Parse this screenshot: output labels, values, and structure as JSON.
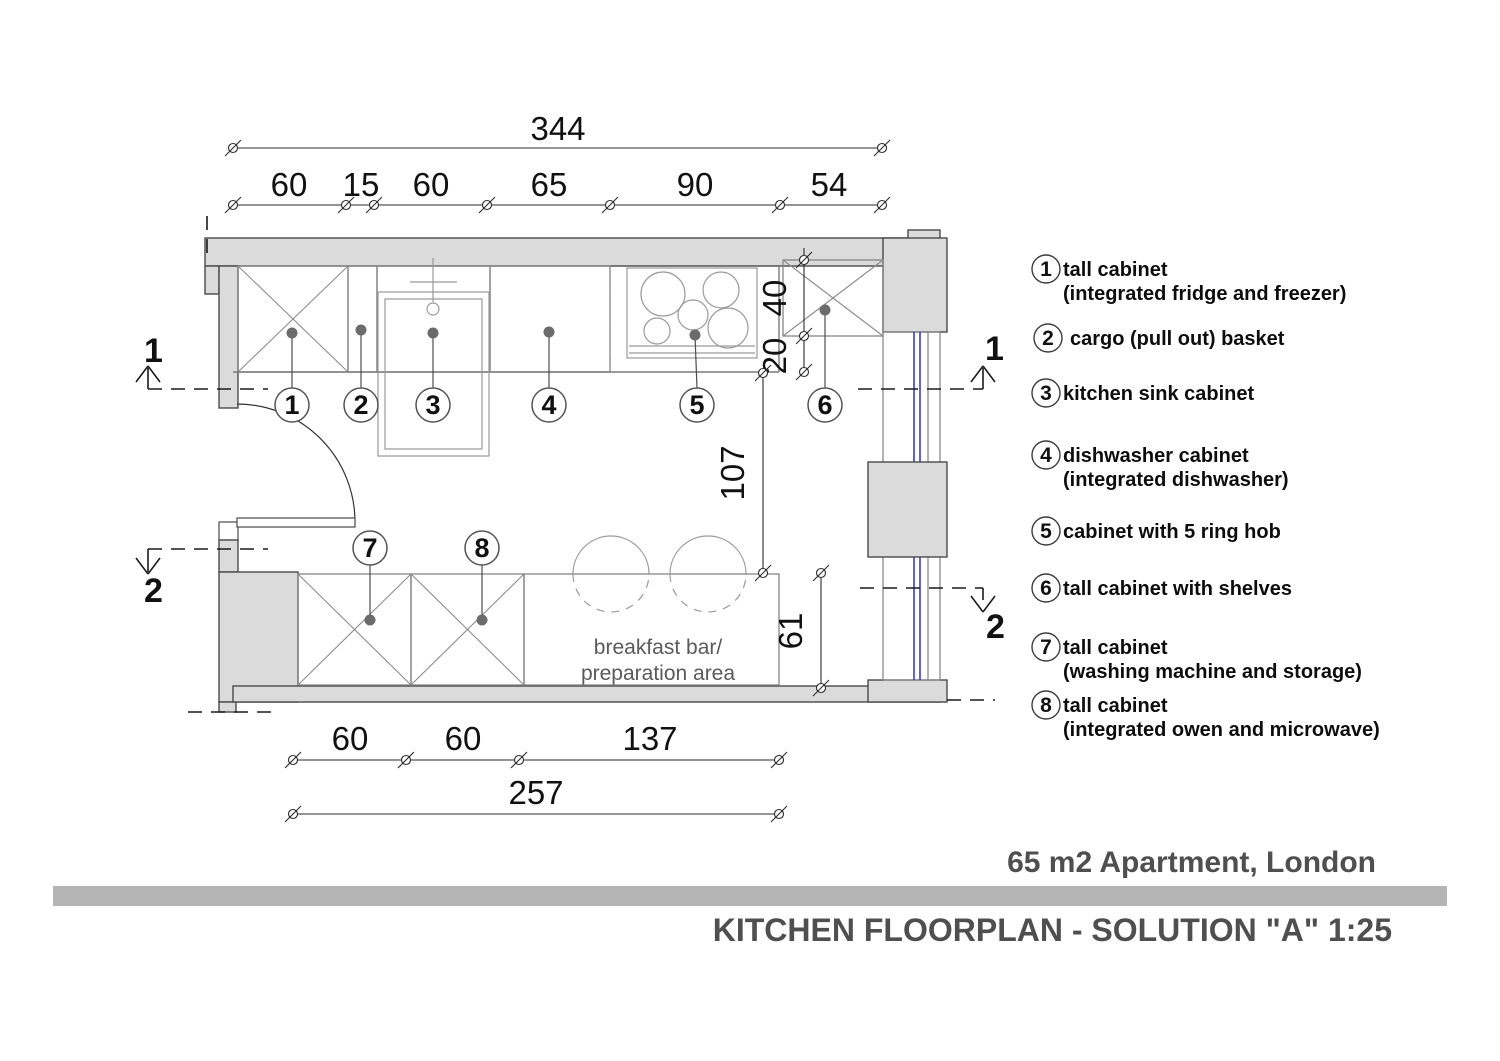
{
  "titles": {
    "project": "65 m2 Apartment, London",
    "drawing": "KITCHEN FLOORPLAN - SOLUTION \"A\" 1:25"
  },
  "dims": {
    "top_total": "344",
    "top_segments": [
      "60",
      "15",
      "60",
      "65",
      "90",
      "54"
    ],
    "right_depth": "40",
    "right_gap": "20",
    "passage": "107",
    "bar_depth": "61",
    "bottom_segments": [
      "60",
      "60",
      "137"
    ],
    "bottom_total": "257"
  },
  "sections": {
    "one": "1",
    "two": "2"
  },
  "plan": {
    "callouts": [
      "1",
      "2",
      "3",
      "4",
      "5",
      "6",
      "7",
      "8"
    ],
    "breakfast": [
      "breakfast bar/",
      "preparation area"
    ]
  },
  "legend": {
    "items": [
      {
        "num": "1",
        "line1": "tall cabinet",
        "line2": "(integrated fridge and freezer)"
      },
      {
        "num": "2",
        "line1": "cargo (pull out) basket",
        "line2": ""
      },
      {
        "num": "3",
        "line1": "kitchen sink cabinet",
        "line2": ""
      },
      {
        "num": "4",
        "line1": "dishwasher cabinet",
        "line2": "(integrated dishwasher)"
      },
      {
        "num": "5",
        "line1": "cabinet with 5 ring hob",
        "line2": ""
      },
      {
        "num": "6",
        "line1": "tall cabinet with shelves",
        "line2": ""
      },
      {
        "num": "7",
        "line1": "tall cabinet",
        "line2": "(washing machine and storage)"
      },
      {
        "num": "8",
        "line1": "tall cabinet",
        "line2": "(integrated owen and microwave)"
      }
    ]
  },
  "colors": {
    "wall_fill": "#dbdbdb",
    "window_glass": "#3a3ad1",
    "divider_bar": "#b5b5b5",
    "title_text": "#4f4f4f"
  }
}
